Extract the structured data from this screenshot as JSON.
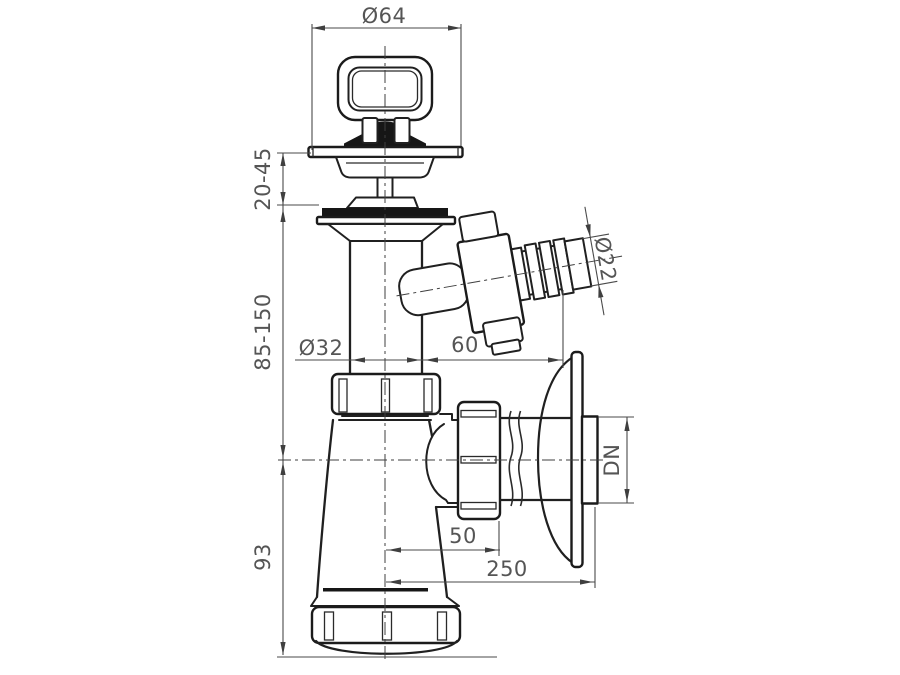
{
  "drawing": {
    "title": "Bottle trap with strainer and washing machine hose branch - dimensioned technical drawing",
    "background": "#ffffff",
    "line_color": "#202020",
    "dim_color": "#4a4a4a",
    "text_color": "#555555",
    "dimensions": {
      "top_diameter": "Ø64",
      "mount_thickness_range": "20-45",
      "tailpipe_length_range": "85-150",
      "tailpipe_diameter": "Ø32",
      "branch_projection": "60",
      "hose_barb_diameter": "Ø22",
      "body_height": "93",
      "outlet_offset": "50",
      "outlet_length": "250",
      "outlet_nominal_diameter": "DN"
    }
  }
}
